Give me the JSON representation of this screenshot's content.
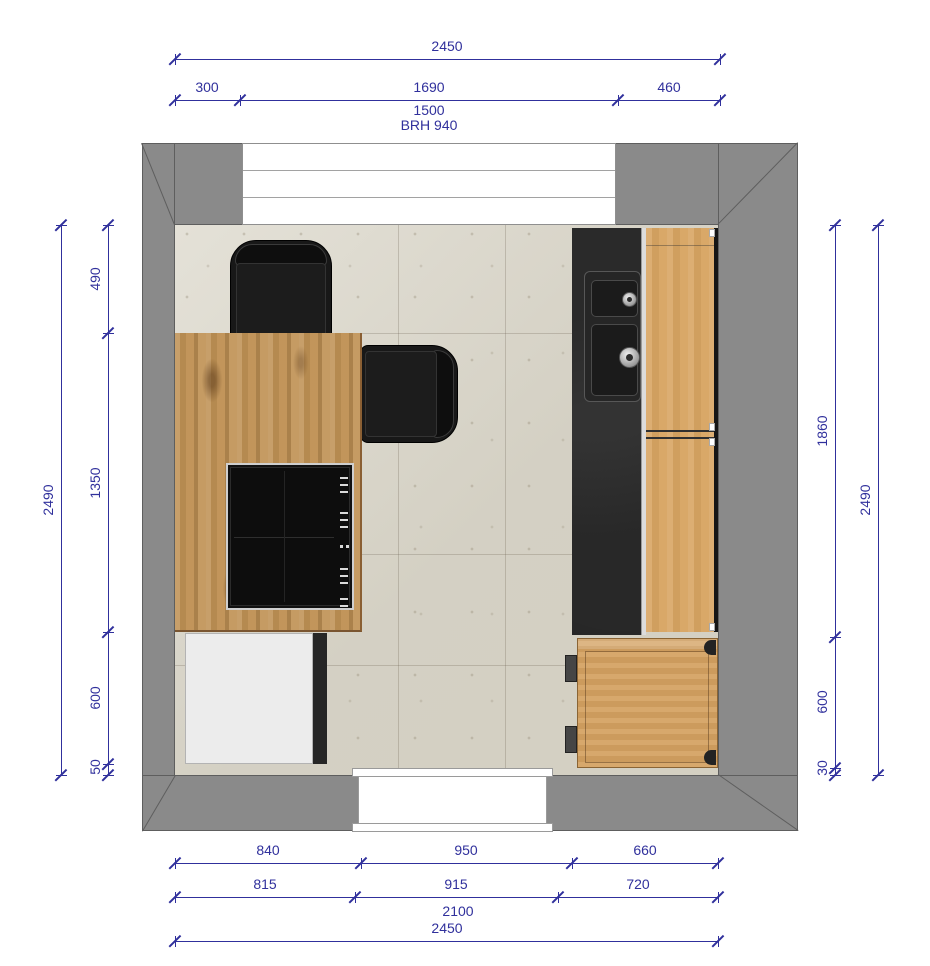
{
  "dims": {
    "top": {
      "overall": "2450",
      "seg_left": "300",
      "seg_mid": "1690",
      "seg_right": "460",
      "window_width": "1500",
      "sill_note": "BRH 940"
    },
    "left": {
      "overall": "2490",
      "segs": [
        "490",
        "1350",
        "600",
        "50"
      ]
    },
    "right": {
      "overall": "2490",
      "segs": [
        "1860",
        "600",
        "30"
      ]
    },
    "bottom": {
      "row1": [
        "840",
        "950",
        "660"
      ],
      "row2": [
        "815",
        "915",
        "720"
      ],
      "mid_total": "2100",
      "overall": "2450"
    }
  },
  "colors": {
    "dim": "#30309c",
    "wall": "#8a8a8a",
    "wall-line": "#5e5e5e",
    "floor": "#dbd7ca",
    "wood-island": "#bf9154",
    "wood-cabinet": "#d8a563",
    "counter-black": "#1f1f1f",
    "chair-black": "#181818",
    "cabinet-white": "#ececec",
    "opening-white": "#ffffff"
  }
}
